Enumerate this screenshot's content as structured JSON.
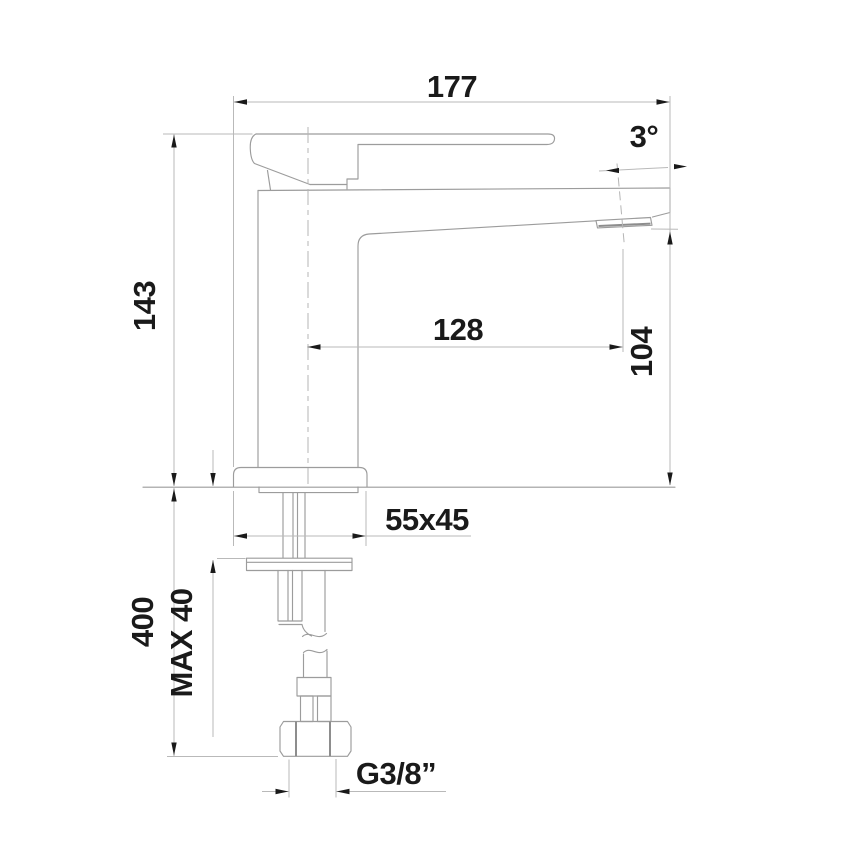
{
  "drawing": {
    "type": "technical-dimension-drawing",
    "subject": "single-lever-basin-mixer-side-view",
    "colors": {
      "background": "#ffffff",
      "outline": "#9c9c9c",
      "dimension_line": "#b9b9b9",
      "annotation": "#1a1a1a"
    },
    "dimensions": {
      "overall_length": "177",
      "spout_angle": "3°",
      "height": "143",
      "spout_reach": "128",
      "spout_outlet_height": "104",
      "base_footprint": "55x45",
      "under_counter_length": "400",
      "max_counter_thickness": "MAX 40",
      "connection_thread": "G3/8”"
    }
  }
}
